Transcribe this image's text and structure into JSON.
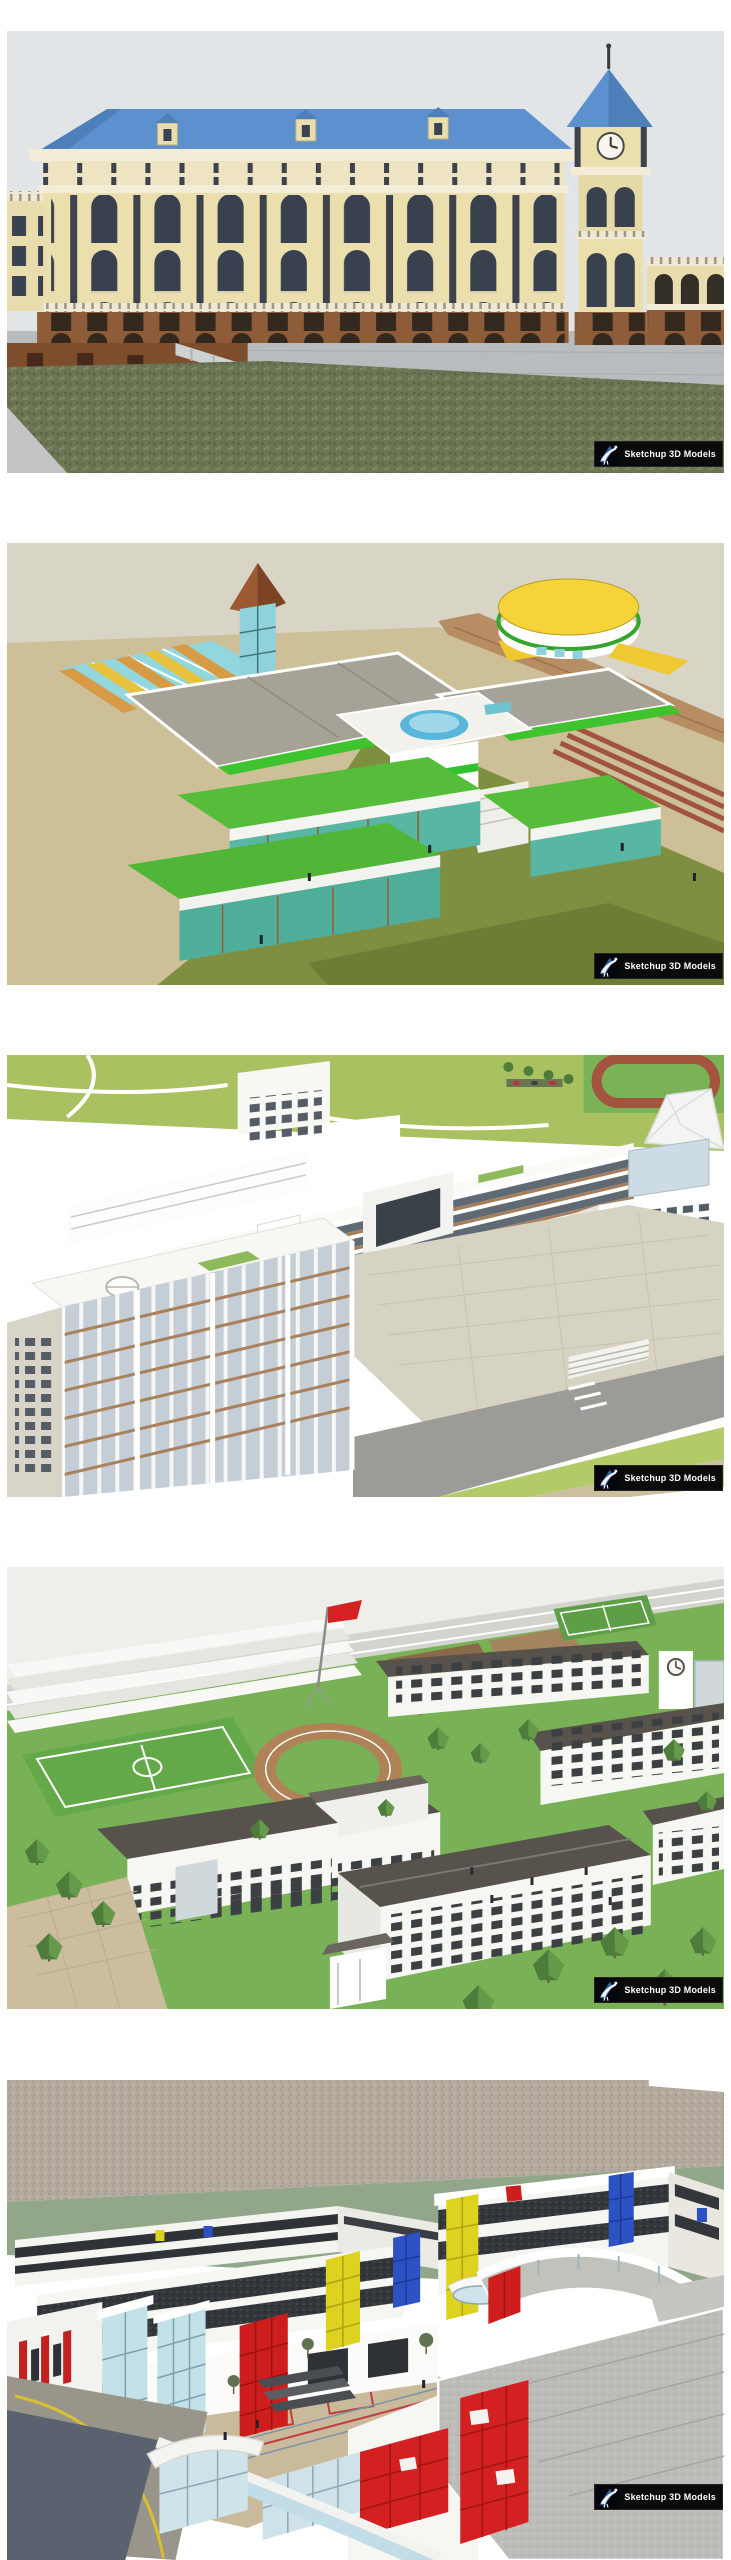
{
  "page": {
    "title": "Sketchup 3D model previews",
    "background": "#ffffff"
  },
  "watermark": {
    "label": "Sketchup 3D Models",
    "logo_icon": "sketchup-3d-models-logo",
    "background": "#0b0b0b",
    "text_color": "#ffffff"
  },
  "gallery": {
    "items": [
      {
        "alt": "Classical school building with clock tower, blue hipped roofs, cream facade, brick base, gray plaza and grass foreground",
        "accent_colors": {
          "sky": "#e1e5e7",
          "roof": "#5d90cf",
          "wall": "#ebdfae",
          "brick": "#8f5c39",
          "plaza": "#b9bcbe",
          "grass": "#6b7453"
        }
      },
      {
        "alt": "Aerial view of kindergarten model with bright green roof terraces, glass tower with brown pyramid roof, round yellow hall, olive lawn and red running lanes",
        "accent_colors": {
          "ground": "#cdbf97",
          "lawn": "#7f8f41",
          "terrace_green": "#4fb637",
          "glass": "#8fd2dc",
          "yellow": "#f5d339",
          "track": "#9e4f3a"
        }
      },
      {
        "alt": "Aerial view of white campus teaching buildings with brown window bands around a paved plaza, running track and tensile canopy",
        "accent_colors": {
          "lawn": "#a9c160",
          "plaza": "#d7d3c3",
          "window_band": "#5f6a74",
          "brick_band": "#a57f5c",
          "track": "#a3543e",
          "road": "#9b9b98"
        }
      },
      {
        "alt": "Aerial view of school campus with white buildings, dark gray pitched roofs, sports field, grandstand, trees and red flag",
        "accent_colors": {
          "lawn": "#79b156",
          "roof": "#57524b",
          "field": "#63a94a",
          "flag": "#d42222",
          "paving": "#cbbd9e"
        }
      },
      {
        "alt": "Modern school campus with white blocks, red, yellow and blue glass accents, curved crescent building, large gray roofs and waterfront plaza",
        "accent_colors": {
          "red": "#ce1d1d",
          "yellow": "#dcd21f",
          "blue": "#2d52c4",
          "roof_gray": "#b4ab9e",
          "olive": "#92a78a",
          "water": "#5a6270"
        }
      }
    ]
  }
}
